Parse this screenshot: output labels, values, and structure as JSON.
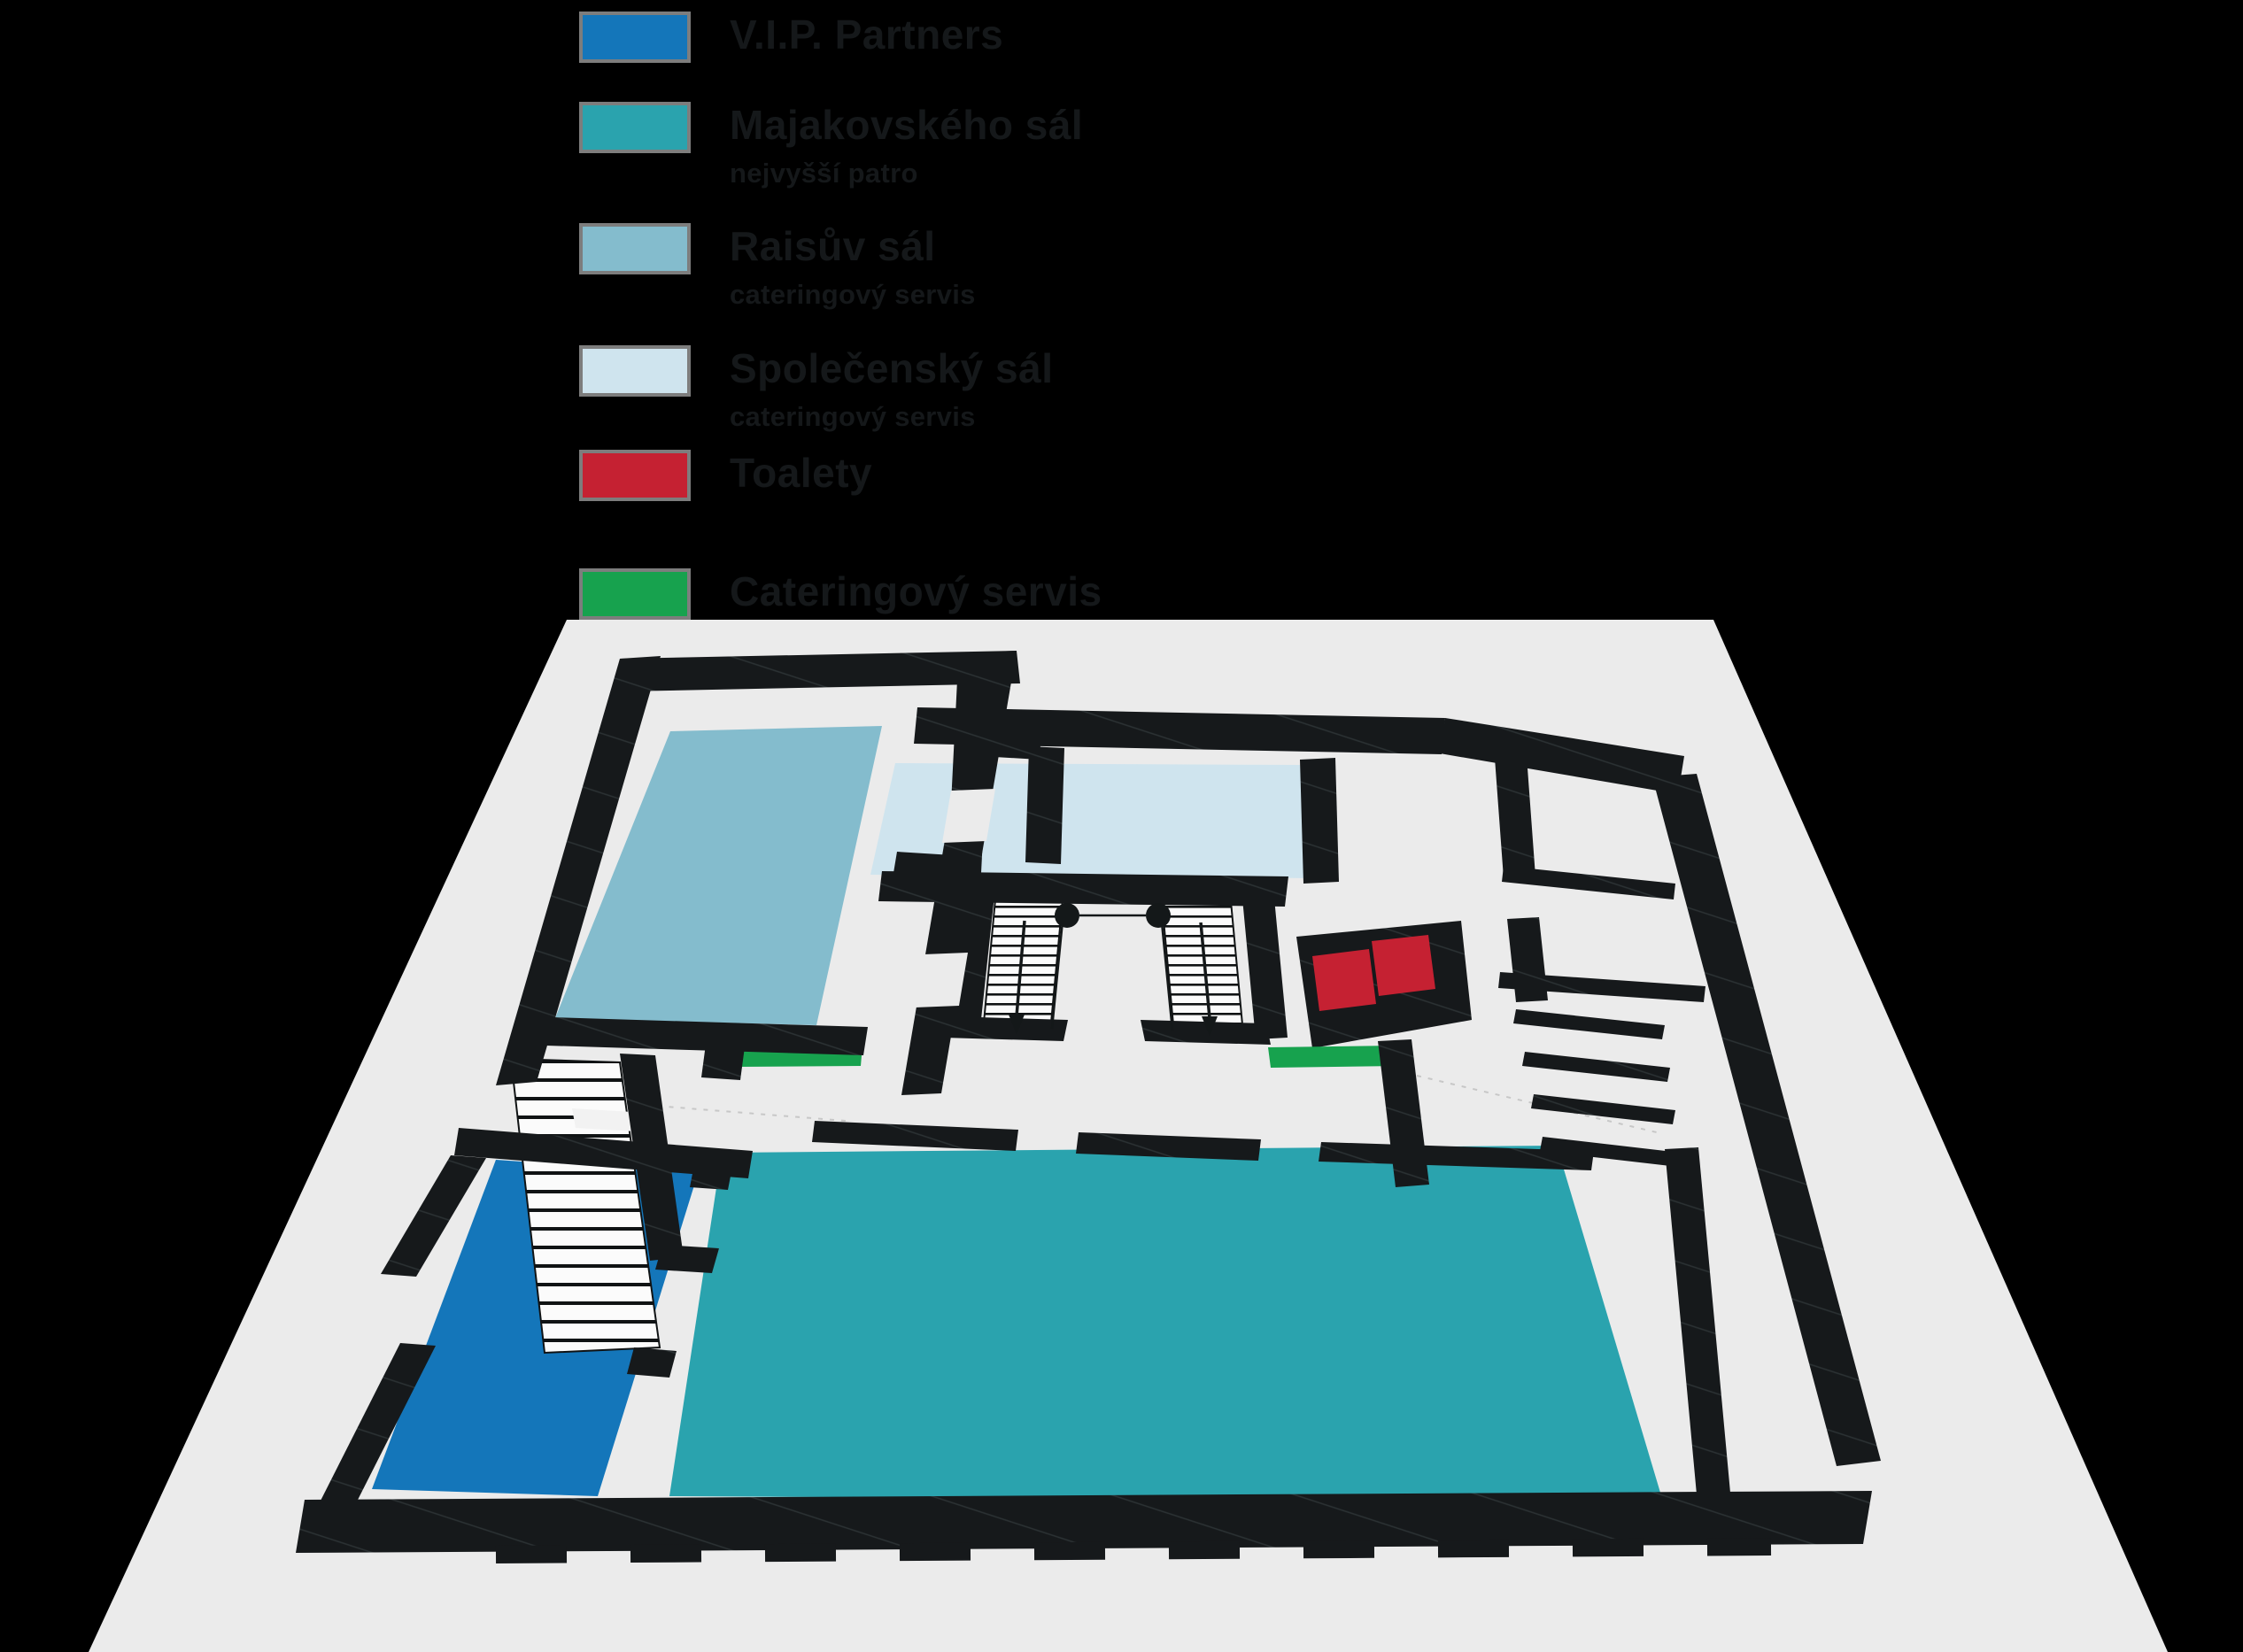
{
  "page": {
    "background_color": "#000000",
    "type": "venue floor plan with legend"
  },
  "legend": {
    "items": [
      {
        "name": "vip-partners",
        "label": "V.I.P. Partners",
        "sublabel": "",
        "color": "#1476ba"
      },
      {
        "name": "majakovskeho-sal",
        "label": "Majakovského sál",
        "sublabel": "nejvyšší patro",
        "color": "#2aa3ae"
      },
      {
        "name": "raisuv-sal",
        "label": "Raisův sál",
        "sublabel": "cateringový servis",
        "color": "#84bccd"
      },
      {
        "name": "spolecensky-sal",
        "label": "Společenský sál",
        "sublabel": "cateringový servis",
        "color": "#cfe4ee"
      },
      {
        "name": "toalety",
        "label": "Toalety",
        "sublabel": "",
        "color": "#c52132"
      },
      {
        "name": "cateringovy-servis",
        "label": "Cateringový servis",
        "sublabel": "",
        "color": "#17a24e"
      }
    ],
    "swatch_border_color": "#7d7d7d",
    "text_color": "#15181a"
  },
  "floor_plan": {
    "background_color": "#ebebeb",
    "wall_color": "#16191b",
    "areas": [
      {
        "name": "raisuv-sal-area",
        "legend_ref": "Raisův sál"
      },
      {
        "name": "spolecensky-sal-area",
        "legend_ref": "Společenský sál"
      },
      {
        "name": "majakovskeho-sal-area",
        "legend_ref": "Majakovského sál"
      },
      {
        "name": "vip-partners-area",
        "legend_ref": "V.I.P. Partners"
      },
      {
        "name": "toalety-area-1",
        "legend_ref": "Toalety"
      },
      {
        "name": "toalety-area-2",
        "legend_ref": "Toalety"
      },
      {
        "name": "catering-strip-left",
        "legend_ref": "Cateringový servis"
      },
      {
        "name": "catering-strip-right",
        "legend_ref": "Cateringový servis"
      }
    ],
    "features": [
      "central double staircase",
      "long side staircase",
      "right wing stairs",
      "entrance teeth marks"
    ]
  }
}
